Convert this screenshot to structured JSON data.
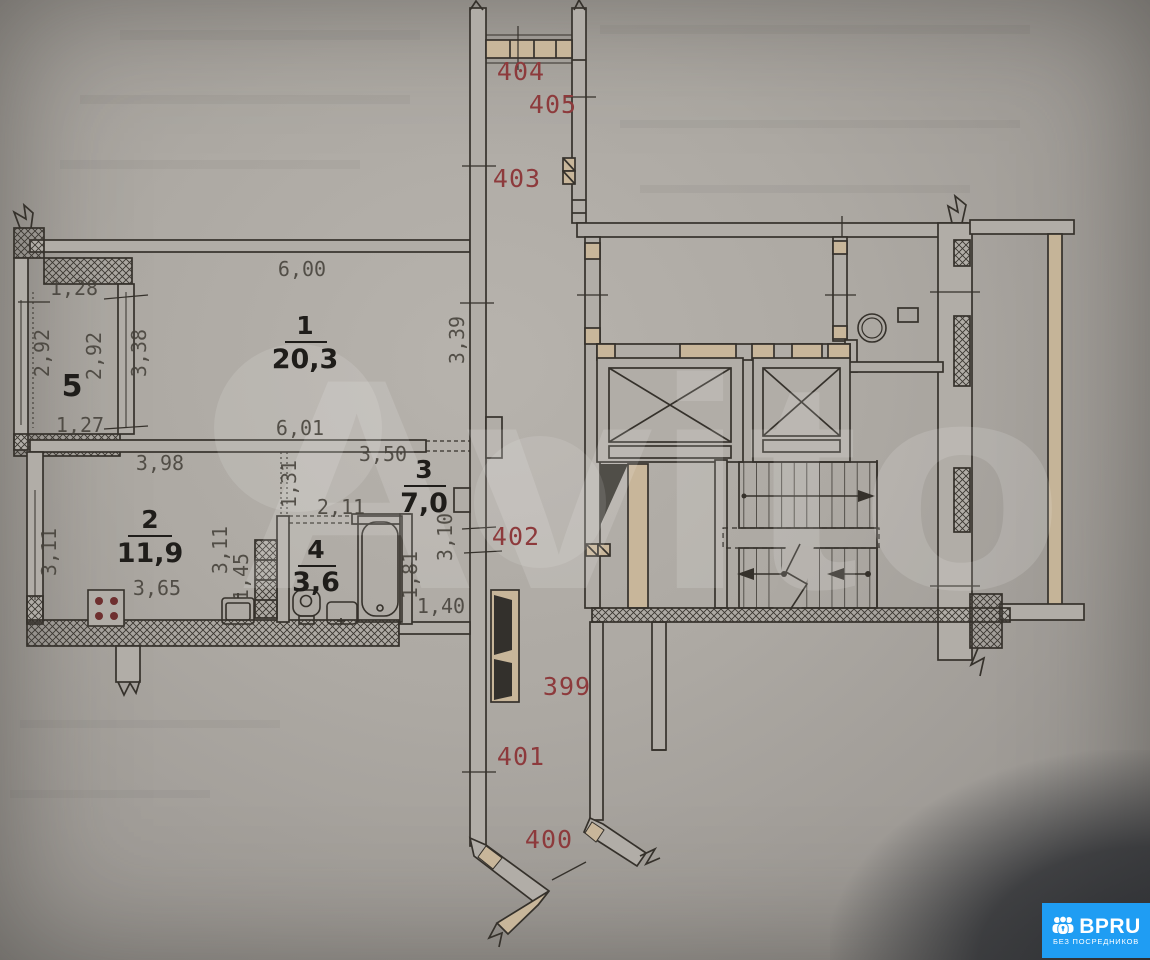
{
  "watermark": {
    "text": "Avito"
  },
  "apartment_labels": {
    "n404": "404",
    "n405": "405",
    "n403": "403",
    "n402": "402",
    "n399": "399",
    "n401": "401",
    "n400": "400"
  },
  "room_labels": {
    "r1": {
      "num": "1",
      "area": "20,3"
    },
    "r2": {
      "num": "2",
      "area": "11,9"
    },
    "r3": {
      "num": "3",
      "area": "7,0"
    },
    "r4": {
      "num": "4",
      "area": "3,6"
    },
    "r5": {
      "num": "5"
    }
  },
  "dimensions": {
    "d128": "1,28",
    "d292a": "2,92",
    "d292b": "2,92",
    "d338": "3,38",
    "d127": "1,27",
    "d600": "6,00",
    "d339": "3,39",
    "d601": "6,01",
    "d398": "3,98",
    "d311a": "3,11",
    "d311b": "3,11",
    "d365": "3,65",
    "d145": "1,45",
    "d350": "3,50",
    "d131": "1,31",
    "d211": "2,11",
    "d310": "3,10",
    "d181": "1,81",
    "d140": "1,40"
  },
  "logo": {
    "brand": "BPRU",
    "tagline": "БЕЗ ПОСРЕДНИКОВ"
  },
  "colors": {
    "wall_line": "#35312b",
    "masonry": "#c8b69a",
    "paper": "#b1ada7",
    "apartment_number": "#8d3a3c",
    "dimension_text": "#45413a",
    "dark_door": "#33302c",
    "logo_blue": "#1f9df3"
  }
}
